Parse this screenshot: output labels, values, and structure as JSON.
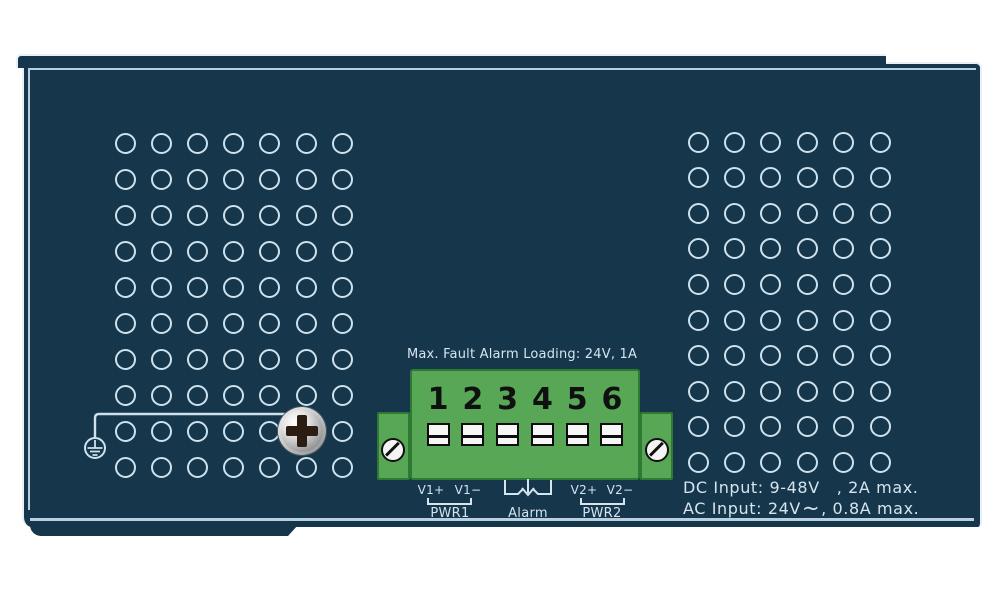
{
  "terminal": {
    "caption": "Max. Fault Alarm Loading: 24V, 1A",
    "numbers": [
      "1",
      "2",
      "3",
      "4",
      "5",
      "6"
    ],
    "pin_labels": {
      "v1_plus": "V1+",
      "v1_minus": "V1−",
      "v2_plus": "V2+",
      "v2_minus": "V2−"
    },
    "group_labels": {
      "pwr1": "PWR1",
      "alarm": "Alarm",
      "pwr2": "PWR2"
    }
  },
  "power_ratings": {
    "dc_prefix": "DC Input: 9-48V",
    "dc_suffix": ", 2A max.",
    "ac_symbol": "~",
    "ac_prefix": "AC Input: 24V",
    "ac_suffix": ", 0.8A max."
  },
  "icons": {
    "ground": "earth-ground-icon",
    "chassis_screw": "phillips-screw-icon",
    "terminal_screws": "slotted-screw-icon",
    "alarm_contact": "alarm-relay-contact-icon",
    "dc": "dc-current-icon",
    "ac": "ac-current-icon"
  },
  "vents": {
    "left": {
      "columns": 7,
      "rows": 10
    },
    "right": {
      "columns": 6,
      "rows": 10
    }
  },
  "colors": {
    "panel_navy": "#16364C",
    "outline_white": "#E8F0F6",
    "hole_stroke": "#CDE2ED",
    "terminal_green": "#57A757",
    "terminal_green_border": "#2E7A32",
    "label_text": "#D6E4EE",
    "terminal_ink": "#111111"
  }
}
